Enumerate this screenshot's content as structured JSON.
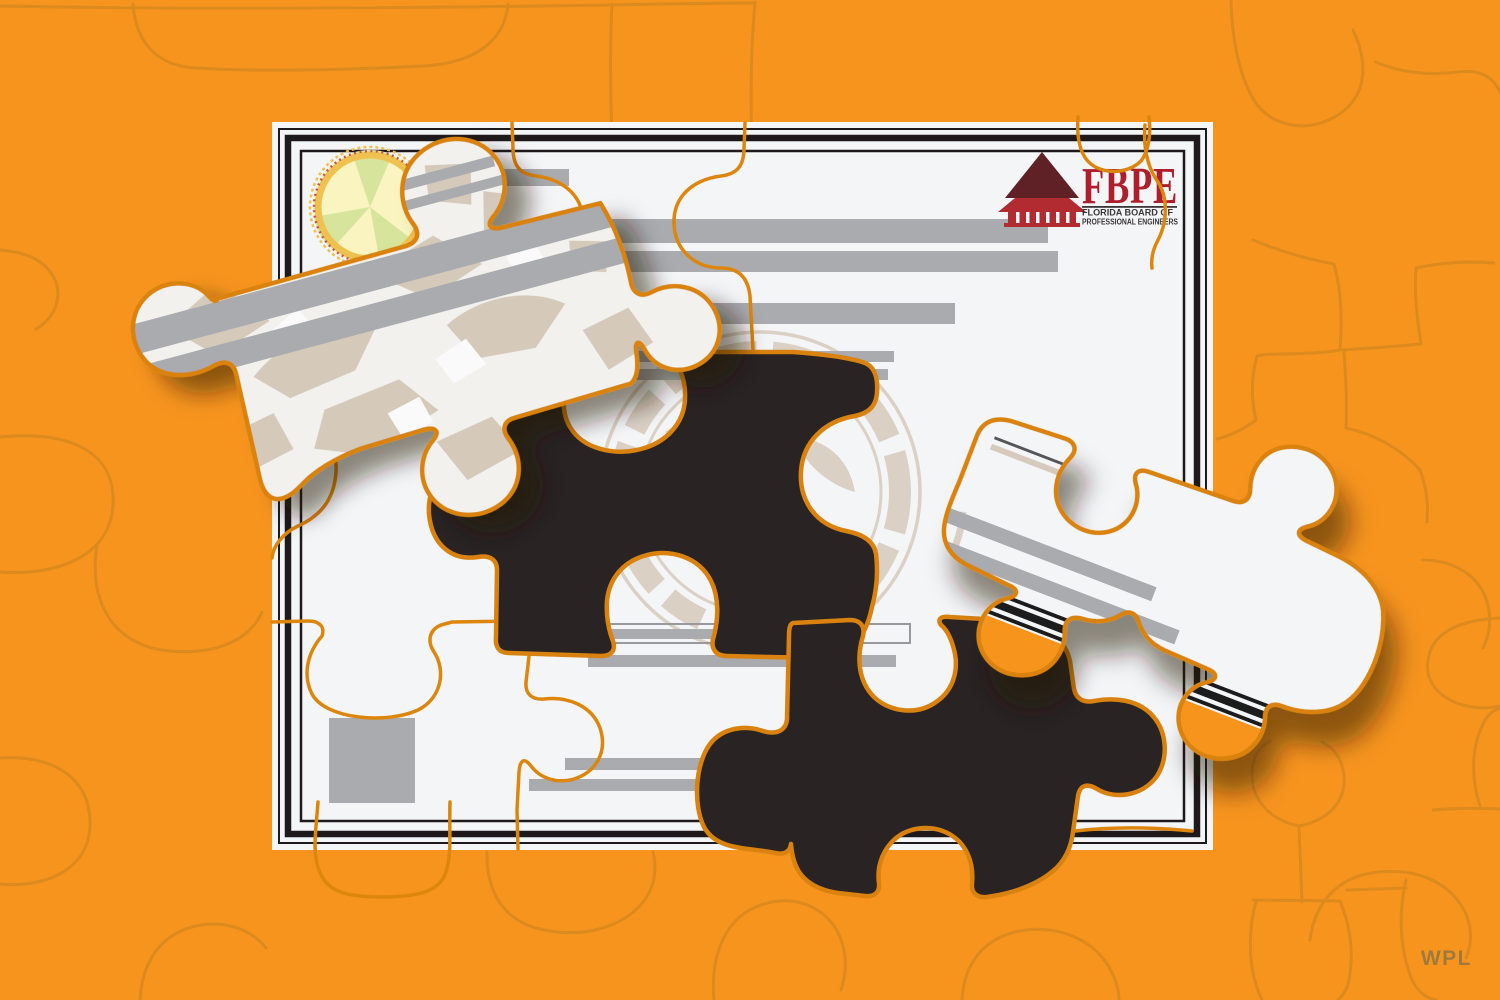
{
  "scene": {
    "description": "Jigsaw puzzle illustration of an engineering license certificate with two missing pieces and two displaced pieces",
    "background_color": "#F7941E",
    "grid_line_color": "#DC8A1E",
    "piece_edge_color": "#D9820F",
    "missing_piece_color": "#292324",
    "watermark": {
      "text": "WPL",
      "color": "#A07A3C"
    }
  },
  "certificate": {
    "paper_color": "#F4F5F7",
    "border_color": "#1E1A1B",
    "redaction_bar_color": "#A9ABAE",
    "seal_watermark_color": "#D9CFC2",
    "gold_seal": {
      "ring": "#EFC150",
      "fill": "#FAF4C0",
      "wedge": "#D6E59B",
      "dots": "#C5574A"
    },
    "logo": {
      "acronym": "FBPE",
      "org_line1": "FLORIDA BOARD OF",
      "org_line2": "PROFESSIONAL ENGINEERS",
      "acronym_color": "#AE1F2E",
      "mark_roof_color": "#5F2126",
      "mark_base_color": "#B22B31",
      "org_text_color": "#3A3637"
    }
  }
}
